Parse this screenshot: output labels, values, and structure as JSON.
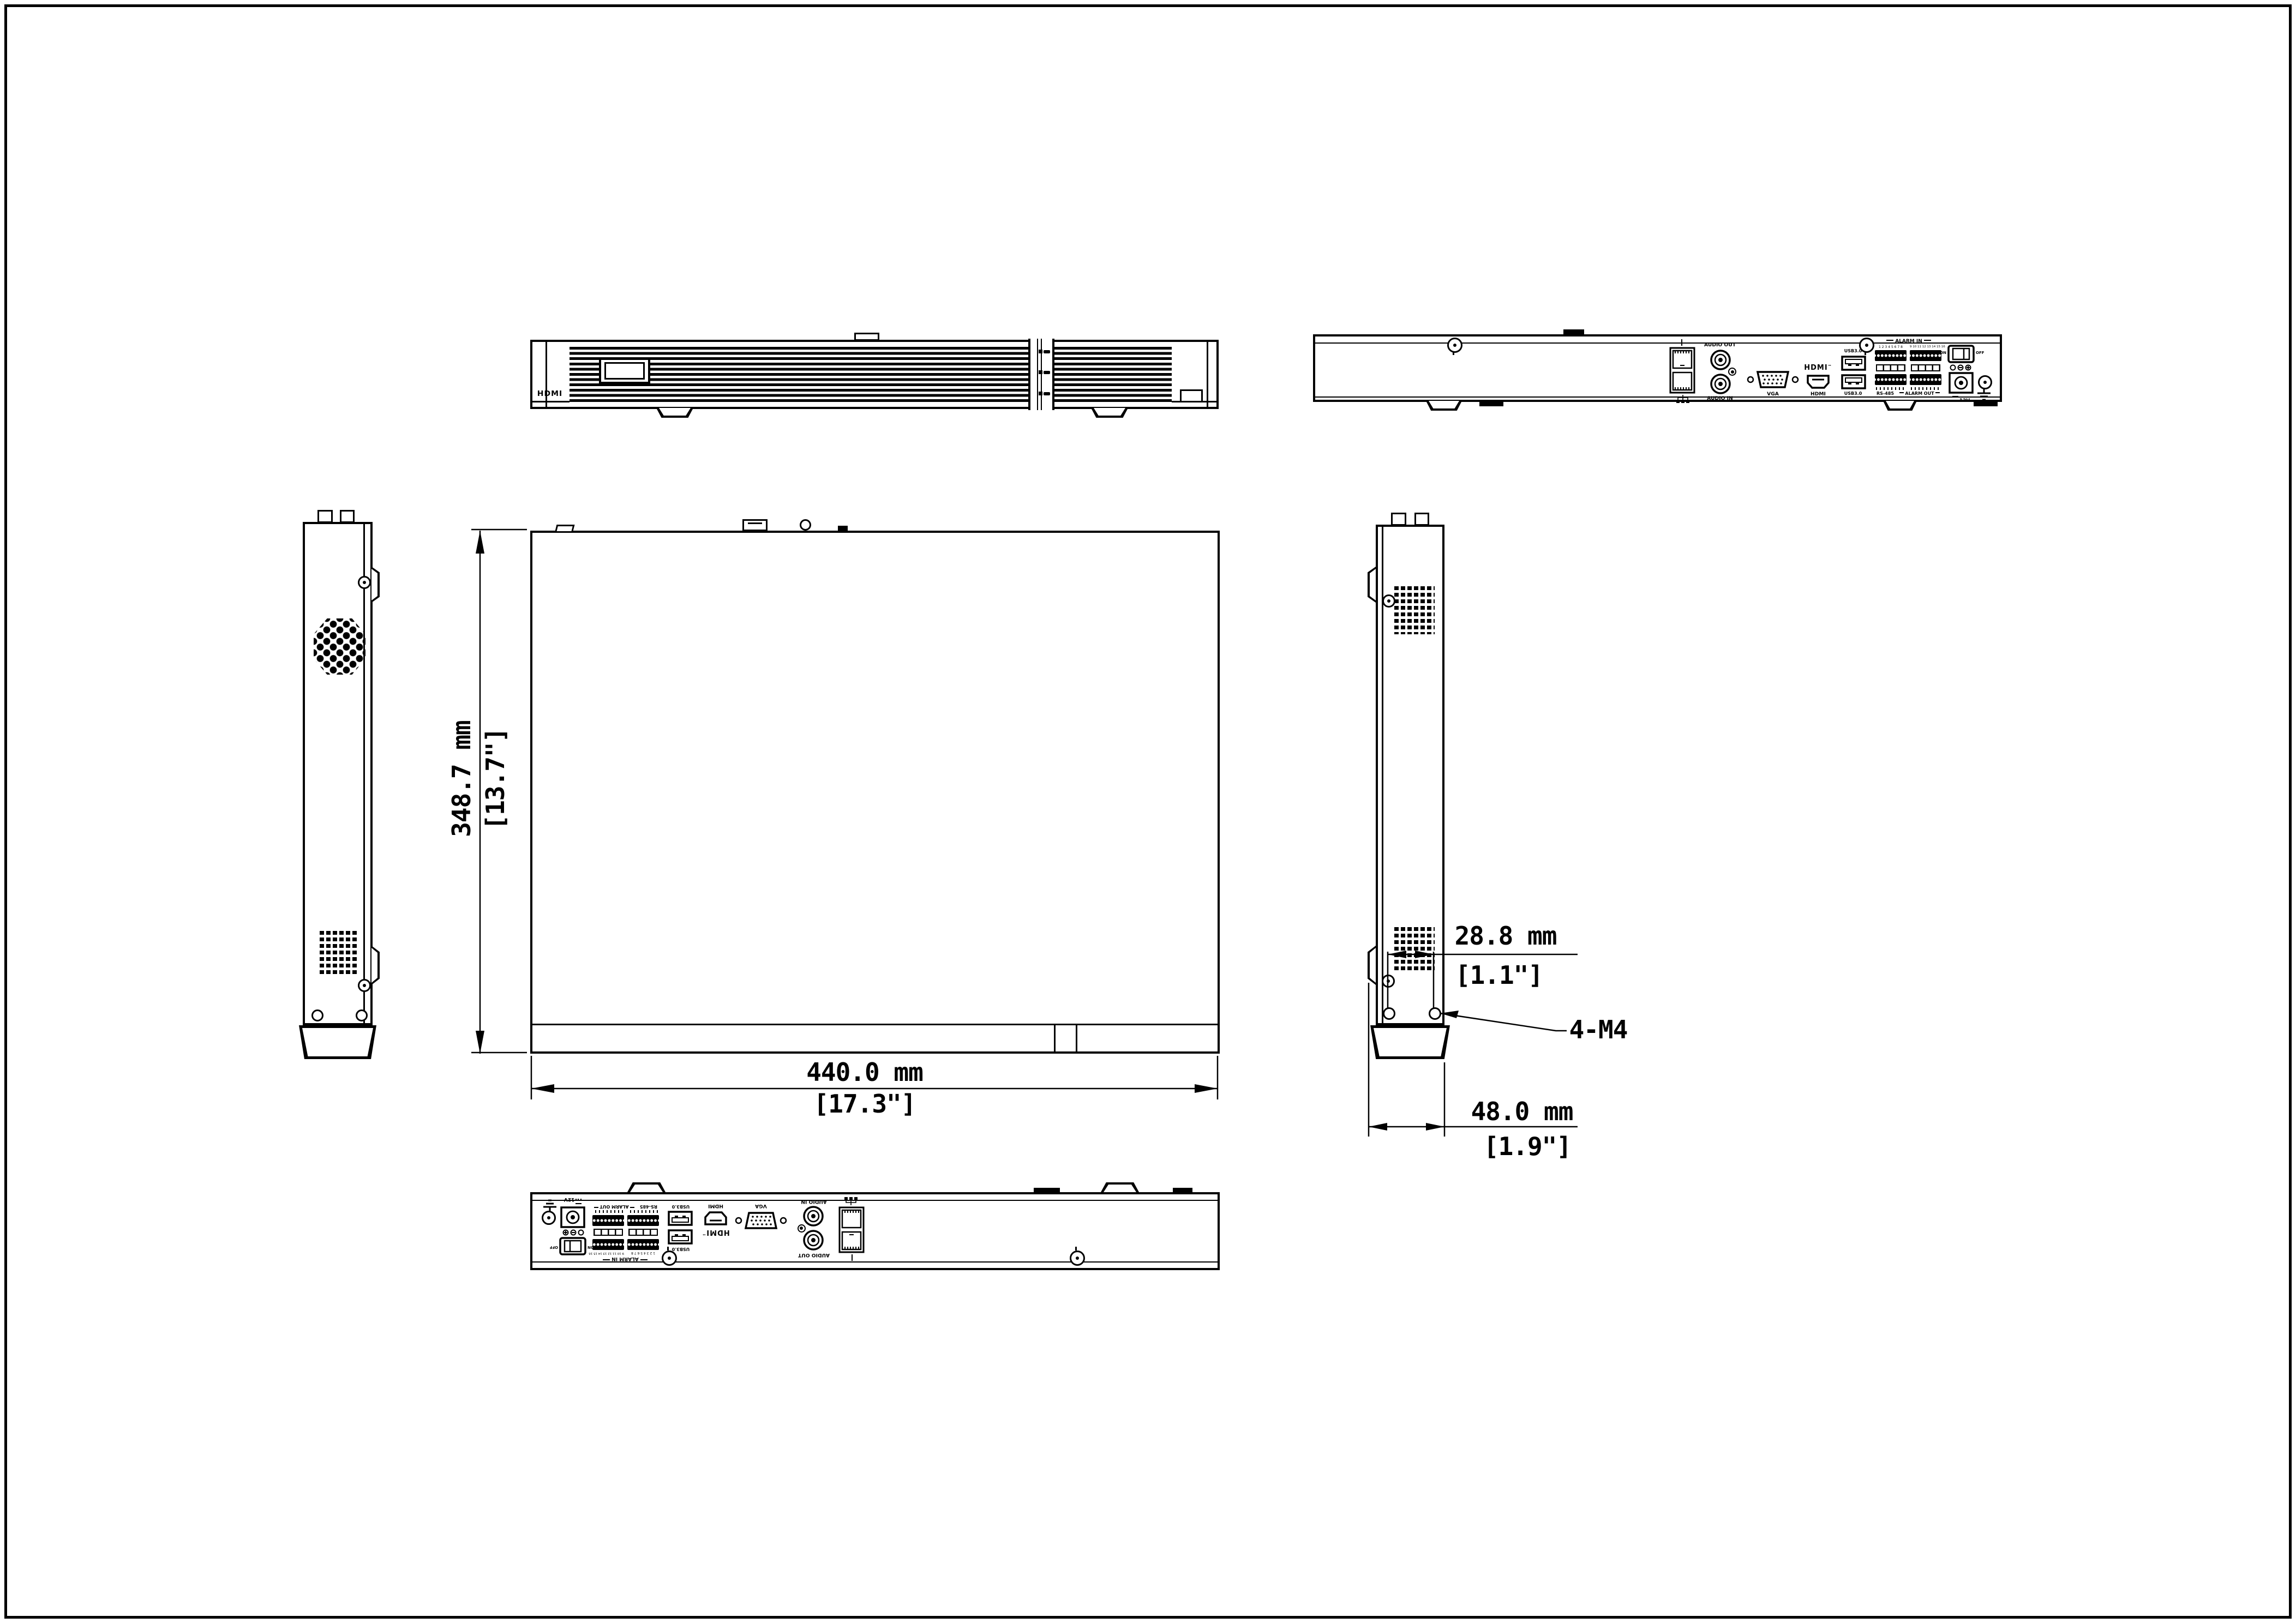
{
  "drawing": {
    "background": "#ffffff",
    "line_color": "#000000",
    "dimensions": {
      "height_mm": "348.7 mm",
      "height_in": "[13.7\"]",
      "width_mm": "440.0 mm",
      "width_in": "[17.3\"]",
      "hole_spacing_mm": "28.8 mm",
      "hole_spacing_in": "[1.1\"]",
      "depth_mm": "48.0 mm",
      "depth_in": "[1.9\"]",
      "mount_screws": "4-M4"
    },
    "front_panel": {
      "logo": "HDMI"
    },
    "rear_panel": {
      "audio_out_label": "AUDIO OUT",
      "audio_in_label": "AUDIO IN",
      "vga_label": "VGA",
      "hdmi_logo": "HDMI",
      "hdmi_tm": "™",
      "hdmi_label": "HDMI",
      "usb_top_label": "USB3.0",
      "usb_bottom_label": "USB3.0",
      "alarm_in_label": "ALARM IN",
      "alarm_in_numbers_left": "1 2 3 4 5 6 7 8",
      "alarm_in_numbers_right": "9 10 11 12 13 14 15 16",
      "rs485_label": "RS-485",
      "alarm_out_label": "ALARM OUT",
      "power_on_label": "ON",
      "power_off_label": "OFF",
      "dc_label": "12V"
    }
  }
}
